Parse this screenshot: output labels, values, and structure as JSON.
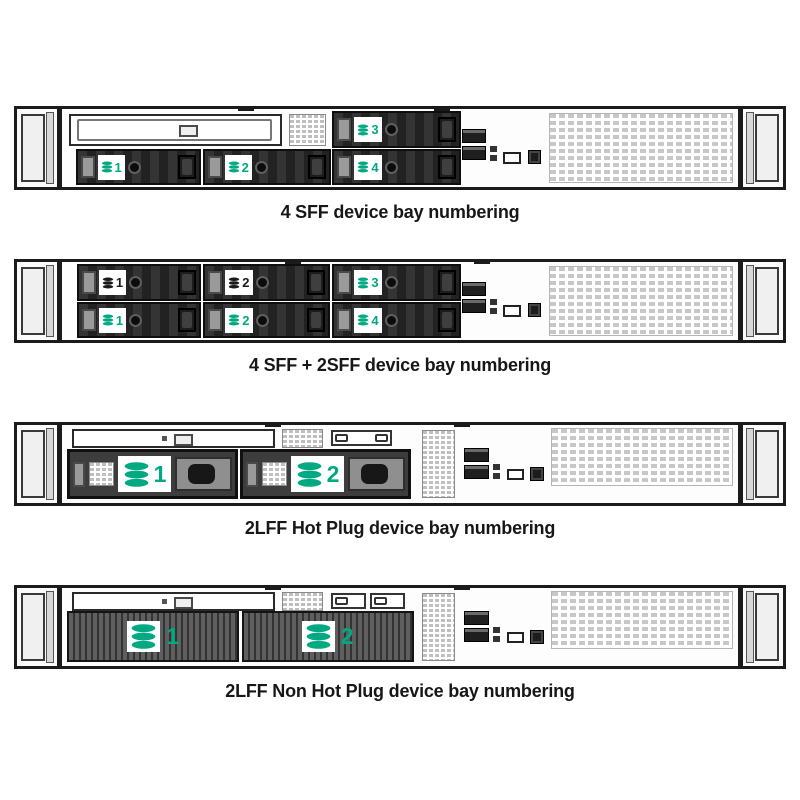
{
  "page": {
    "background": "#ffffff"
  },
  "colors": {
    "hpe_green": "#01A982",
    "label_black": "#1a1a1a"
  },
  "figures": [
    {
      "caption": "4 SFF device bay numbering",
      "bays": [
        {
          "num": "1",
          "color": "green"
        },
        {
          "num": "2",
          "color": "green"
        },
        {
          "num": "3",
          "color": "green"
        },
        {
          "num": "4",
          "color": "green"
        }
      ]
    },
    {
      "caption": "4 SFF + 2SFF device bay numbering",
      "bays_top": [
        {
          "num": "1",
          "color": "black"
        },
        {
          "num": "2",
          "color": "black"
        },
        {
          "num": "3",
          "color": "green"
        }
      ],
      "bays_bottom": [
        {
          "num": "1",
          "color": "green"
        },
        {
          "num": "2",
          "color": "green"
        },
        {
          "num": "4",
          "color": "green"
        }
      ]
    },
    {
      "caption": "2LFF Hot Plug device bay numbering",
      "bays": [
        {
          "num": "1",
          "color": "green"
        },
        {
          "num": "2",
          "color": "green"
        }
      ]
    },
    {
      "caption": "2LFF Non Hot Plug device bay numbering",
      "bays": [
        {
          "num": "1",
          "color": "green"
        },
        {
          "num": "2",
          "color": "green"
        }
      ]
    }
  ]
}
